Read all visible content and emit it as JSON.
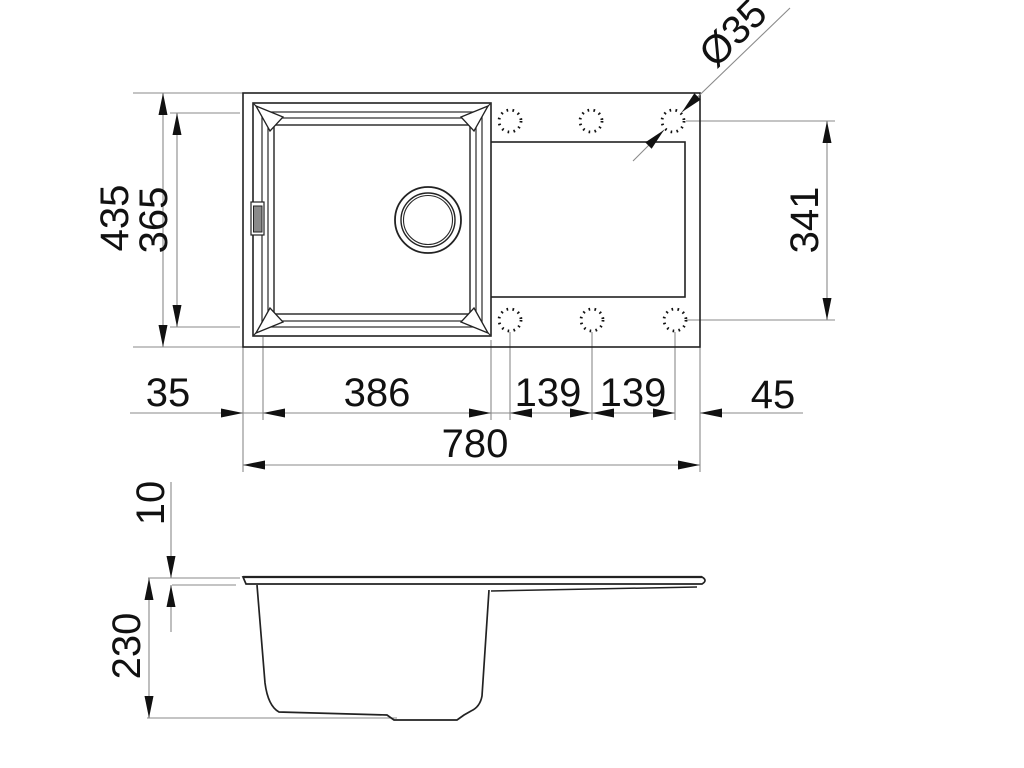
{
  "diagram": {
    "subject": "sink-technical-drawing",
    "top_view": {
      "overall_depth": "435",
      "bowl_opening_depth": "365",
      "tap_hole_diameter": "Ø35",
      "tap_hole_row_span": "341",
      "left_rim_width": "35",
      "bowl_opening_width": "386",
      "tap_hole_spacing_a": "139",
      "tap_hole_spacing_b": "139",
      "right_edge_to_hole": "45",
      "overall_width": "780"
    },
    "side_view": {
      "rim_thickness": "10",
      "bowl_depth": "230"
    }
  }
}
